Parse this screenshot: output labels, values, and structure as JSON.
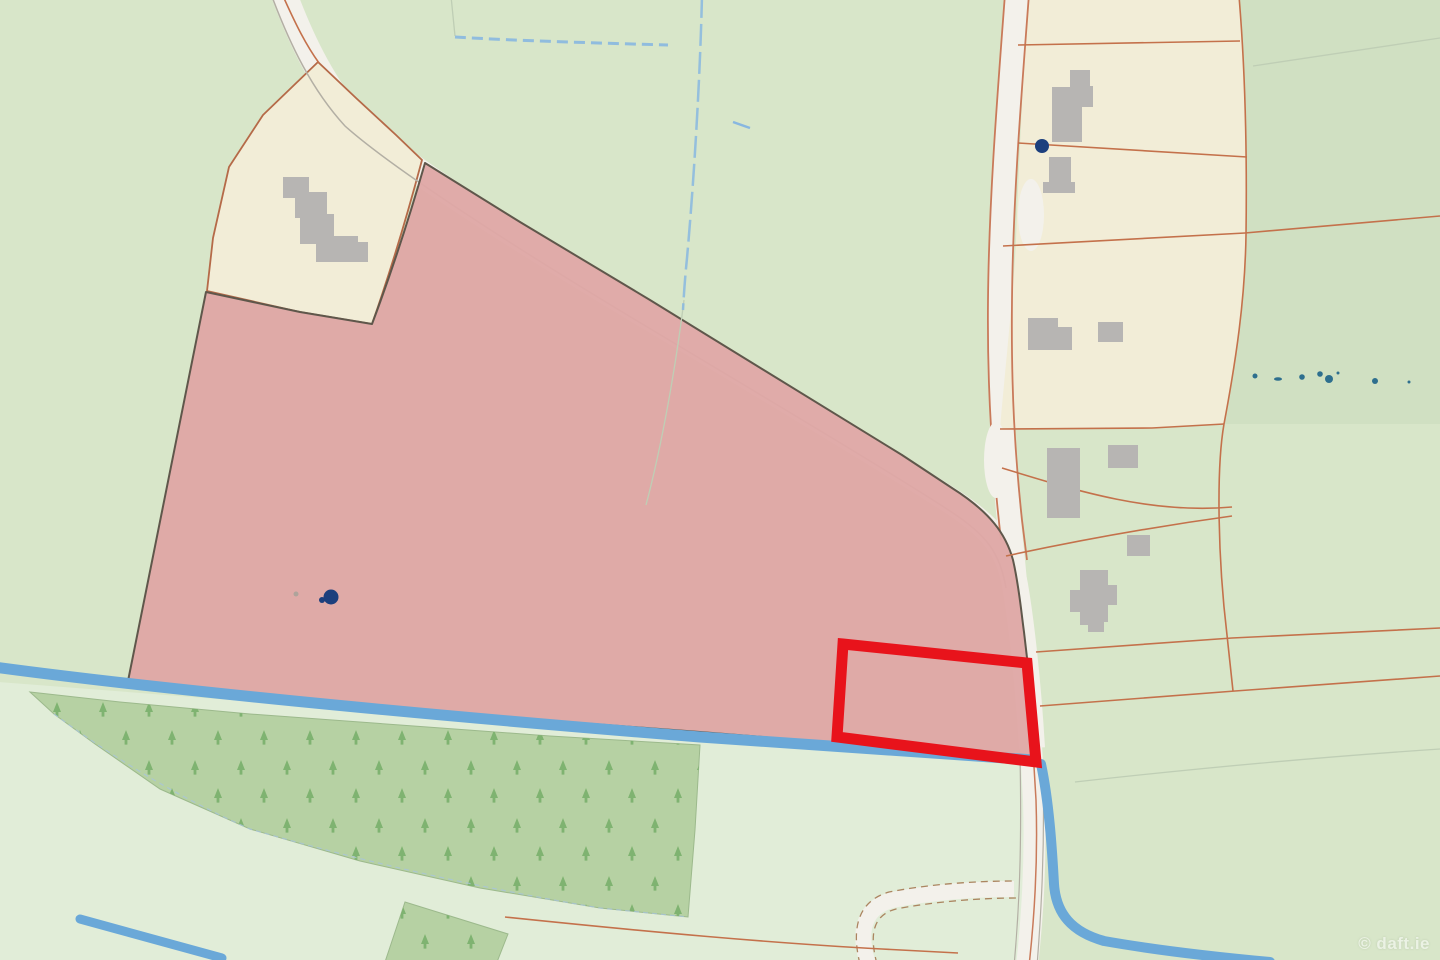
{
  "map": {
    "kind": "cadastral-land-registry-map",
    "watermark": {
      "text": "© daft.ie"
    },
    "colors": {
      "field_green": "#d8e6c9",
      "field_green_dark": "#d0e0c2",
      "field_green_light": "#e1edd8",
      "forest_green": "#b6d1a3",
      "tree_green": "#79b06b",
      "parcel_pink": "#dfa8a6",
      "parcel_cream": "#f2edd7",
      "road_fill": "#f3f1eb",
      "road_edge_gray": "#b3afa4",
      "road_edge_orange": "#c97a5a",
      "boundary_dark": "#5f574b",
      "boundary_orange": "#c4714b",
      "cream_outline": "#b56a48",
      "track_brown": "#ab8560",
      "stream_blue": "#6aa8d8",
      "drain_blue": "#88b7e0",
      "forest_edge": "#9cb98c",
      "forest_edge_dash_blue": "#a9c4da",
      "building_gray": "#b7b5b3",
      "well_navy": "#1c3f7d",
      "dot_teal": "#2e6f8e",
      "highlight_red": "#e8131b",
      "faint_line": "#bfceb5",
      "watermark_white": "#ffffff"
    }
  }
}
